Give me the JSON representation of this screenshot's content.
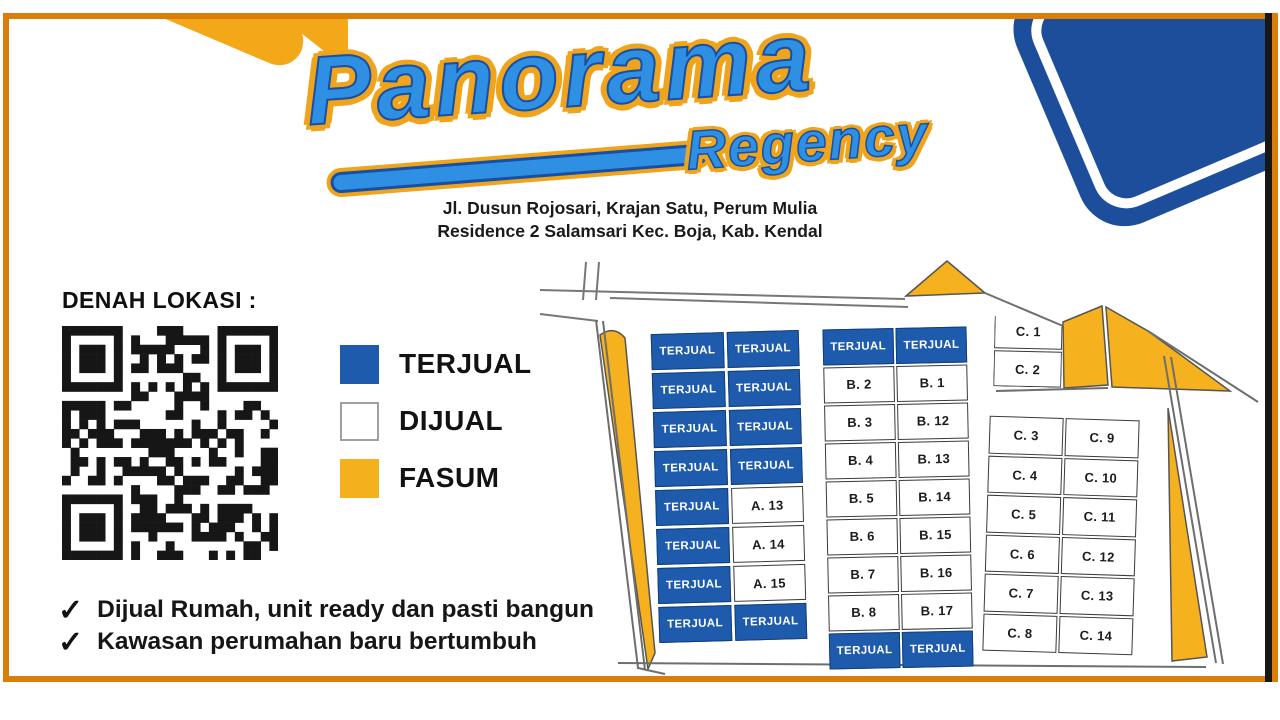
{
  "page": {
    "colors": {
      "frame_orange": "#DA7E07",
      "sold_blue": "#1E5BAD",
      "fasum_yellow": "#F6B11F",
      "card_navy": "#1C4E9B",
      "logo_blue": "#2F8FE2",
      "logo_outline": "#1650A5",
      "logo_glow": "#F0A41C",
      "qr_black": "#161616"
    }
  },
  "header": {
    "logo_primary": "Panorama",
    "logo_secondary": "Regency",
    "address_line1": "Jl. Dusun Rojosari, Krajan Satu, Perum Mulia",
    "address_line2": "Residence 2 Salamsari Kec. Boja, Kab. Kendal"
  },
  "sidebar": {
    "section_title": "DENAH LOKASI :",
    "check_glyph": "✓",
    "legend": [
      {
        "label": "TERJUAL",
        "color": "#1E5BAD",
        "border": "#1E5BAD"
      },
      {
        "label": "DIJUAL",
        "color": "#FFFFFF",
        "border": "#A0A0A0"
      },
      {
        "label": "FASUM",
        "color": "#F5B11D",
        "border": "#F5B11D"
      }
    ],
    "checklist": [
      "Dijual Rumah, unit ready dan pasti bangun",
      "Kawasan perumahan baru bertumbuh"
    ]
  },
  "site_plan": {
    "sold_label": "TERJUAL",
    "blocks": {
      "A": {
        "rows": [
          [
            "TERJUAL",
            "TERJUAL"
          ],
          [
            "TERJUAL",
            "TERJUAL"
          ],
          [
            "TERJUAL",
            "TERJUAL"
          ],
          [
            "TERJUAL",
            "TERJUAL"
          ],
          [
            "TERJUAL",
            "A. 13"
          ],
          [
            "TERJUAL",
            "A. 14"
          ],
          [
            "TERJUAL",
            "A. 15"
          ],
          [
            "TERJUAL",
            "TERJUAL"
          ]
        ]
      },
      "B": {
        "rows": [
          [
            "TERJUAL",
            "TERJUAL"
          ],
          [
            "B. 2",
            "B. 1"
          ],
          [
            "B. 3",
            "B. 12"
          ],
          [
            "B. 4",
            "B. 13"
          ],
          [
            "B. 5",
            "B. 14"
          ],
          [
            "B. 6",
            "B. 15"
          ],
          [
            "B. 7",
            "B. 16"
          ],
          [
            "B. 8",
            "B. 17"
          ],
          [
            "TERJUAL",
            "TERJUAL"
          ]
        ]
      },
      "Ctop": {
        "rows": [
          [
            "C. 1"
          ],
          [
            "C. 2"
          ]
        ]
      },
      "C": {
        "rows": [
          [
            "C. 3",
            "C. 9"
          ],
          [
            "C. 4",
            "C. 10"
          ],
          [
            "C. 5",
            "C. 11"
          ],
          [
            "C. 6",
            "C. 12"
          ],
          [
            "C. 7",
            "C. 13"
          ],
          [
            "C. 8",
            "C. 14"
          ]
        ]
      }
    }
  }
}
